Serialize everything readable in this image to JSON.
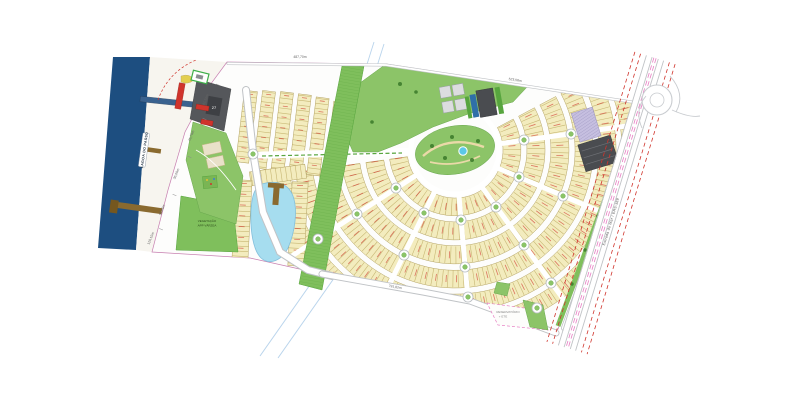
{
  "plan": {
    "labels": {
      "lagoon": "LAGOA DO PASSO",
      "vegetation_line1": "VEGETAÇÃO",
      "vegetation_line2": "APP VÁRZEA",
      "reservoir_line1": "RESERVATÓRIO",
      "reservoir_line2": "+ ETE",
      "highway": "Estrada do Mar / ERS-389",
      "block_number": "27"
    },
    "dimensions": {
      "top_west": "487,70m",
      "top_east": "523,58m",
      "bottom": "791,82m",
      "shore_segments": [
        "81,56m",
        "45,70m",
        "36,60m",
        "93,66m",
        "110,15m"
      ]
    },
    "colors": {
      "lagoon_water": "#1d4e80",
      "pond_water": "#a6ddef",
      "pool_blue": "#5bc8e8",
      "lot_fill": "#f3ecbe",
      "lot_stroke": "#b3a263",
      "park_green": "#8cc468",
      "app_green": "#7fbf5c",
      "road_white": "#ffffff",
      "road_casing": "#c0c3c6",
      "building_gray": "#4a4c50",
      "accent_red": "#d0342c",
      "boundary_magenta": "#e77fc3",
      "parking_lavender": "#c6bfe0",
      "pier_brown": "#8a6a2f",
      "survey_blue": "#b9d4ec",
      "beach_sand": "#f7f5ef"
    }
  }
}
